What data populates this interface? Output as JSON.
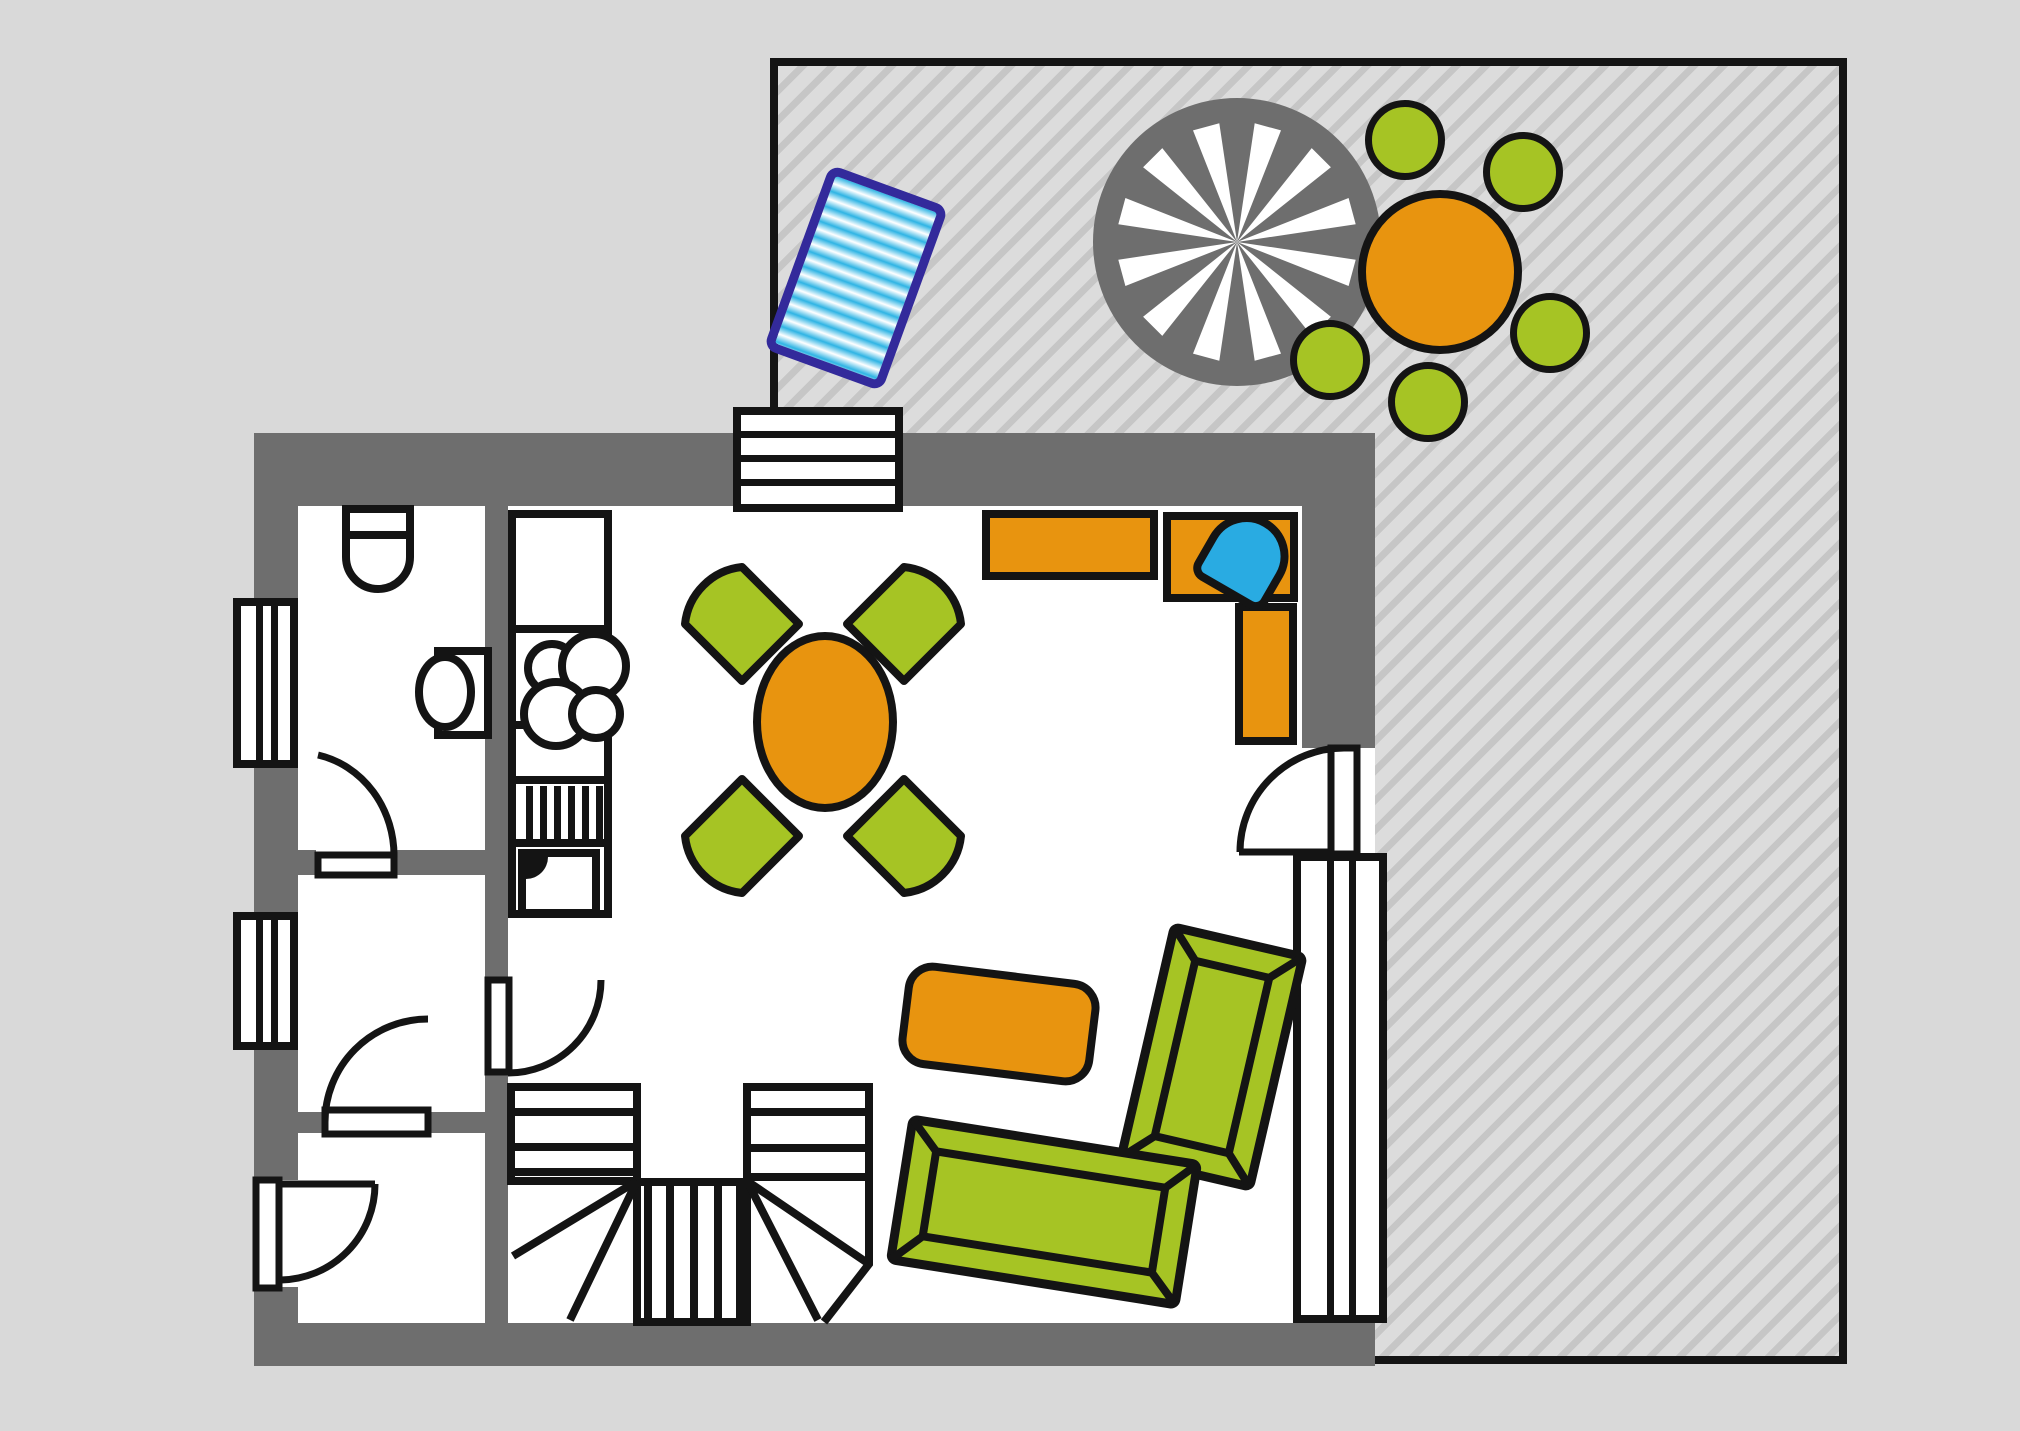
{
  "colors": {
    "bg": "#d9d9d9",
    "terrace-fill": "#dcdcdc",
    "terrace-stripe": "#c6c6c6",
    "wall": "#6e6e6e",
    "ink": "#141414",
    "orange": "#e8940f",
    "green": "#a6c424",
    "blue": "#29abe2",
    "lounger-border": "#332a9b",
    "paper": "#ffffff"
  },
  "scene": {
    "type": "apartment-floor-plan-with-terrace",
    "rooms": [
      "bathroom",
      "hallway",
      "entry-room",
      "kitchen-living-room",
      "terrace"
    ],
    "furniture": [
      "terrace-parasol",
      "terrace-table",
      "terrace-chairs-x5",
      "sun-lounger",
      "toilet",
      "washbasin",
      "kitchen-counter-column",
      "stove-4-burners",
      "dishwasher",
      "kitchen-sink",
      "dining-table",
      "dining-chairs-x4",
      "l-shaped-counter",
      "desk-chair-blue",
      "coffee-table",
      "sofa-right",
      "sofa-bottom",
      "u-shaped-staircase",
      "windows-x4",
      "doors-x6"
    ]
  }
}
